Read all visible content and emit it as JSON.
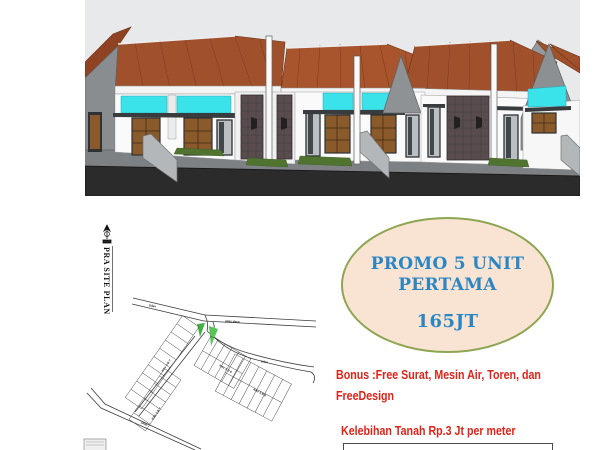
{
  "page": {
    "type": "real-estate promo flyer"
  },
  "hero": {
    "alt": "3D render of a row of one-storey houses with brown roofs and cyan transom bands",
    "colors": {
      "sky": "#e7e9eb",
      "roof": "#a0512c",
      "wall": "#fafafa",
      "accent_cyan": "#3ae2ea",
      "door_wood": "#8a5a2b",
      "stone_panel": "#584c4e",
      "road": "#2c2b2b",
      "grass": "#50742f"
    }
  },
  "site_plan": {
    "title": "PRA SITE PLAN",
    "road_label_main": "jalan desa",
    "road_label_side": "jalan",
    "block_label_a": "KAV 5 B 7",
    "block_label_b": "KAV 5 B 6"
  },
  "promo": {
    "line1": "PROMO 5 UNIT",
    "line2": "PERTAMA",
    "price": "165JT",
    "text_color": "#2b86c4",
    "fill": "#f9e4d3",
    "border_color": "#8ea551"
  },
  "offers": {
    "bonus": "Bonus :Free Surat, Mesin Air, Toren, dan\nFreeDesign",
    "land_note": "Kelebihan Tanah Rp.3 Jt per meter",
    "text_color": "#e02318"
  }
}
